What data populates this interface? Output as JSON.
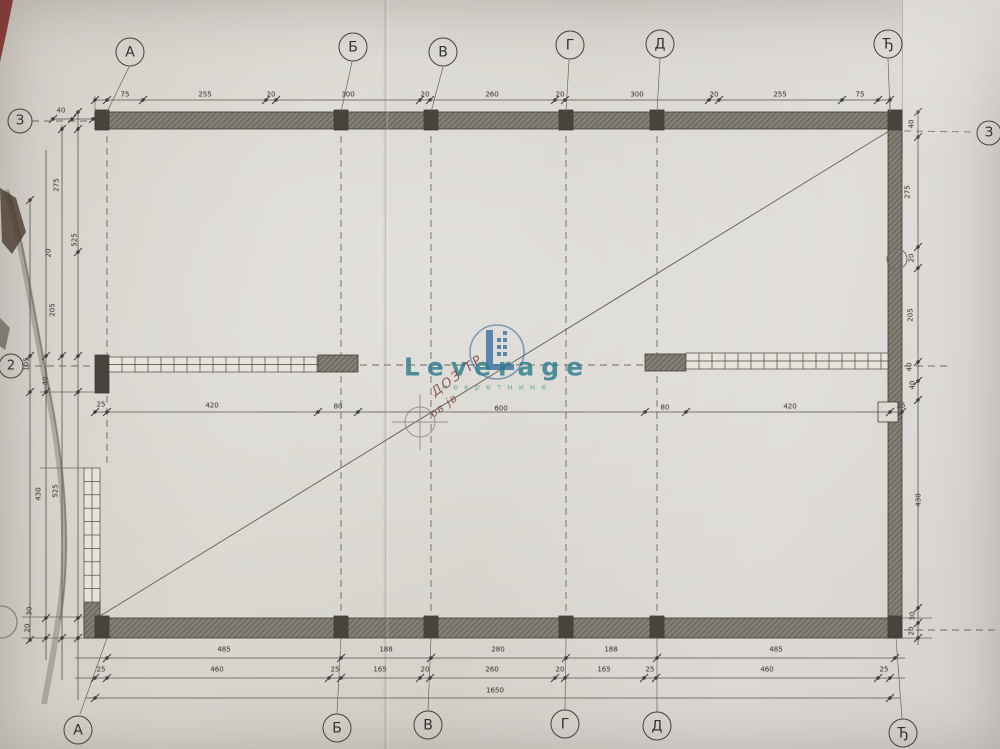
{
  "colors": {
    "paper": "#d8d5ce",
    "line": "#4a4741",
    "wall": "#847f75",
    "wall_dark": "#47443e",
    "accent_teal": "#2e7d8f",
    "accent_green": "#45a08c",
    "accent_blue": "#3b6ea5",
    "stamp_red": "#84453d"
  },
  "axes": {
    "top": [
      "А",
      "Б",
      "В",
      "Г",
      "Д",
      "Ђ"
    ],
    "bottom": [
      "А",
      "Б",
      "В",
      "Г",
      "Д",
      "Ђ"
    ],
    "left": [
      "З",
      "2"
    ],
    "right": [
      "З"
    ]
  },
  "dims": {
    "top": [
      "75",
      "255",
      "20",
      "300",
      "20",
      "260",
      "20",
      "300",
      "20",
      "255",
      "75"
    ],
    "top_small_left": [
      "40"
    ],
    "mid": [
      "25",
      "420",
      "80",
      "600",
      "80",
      "420",
      "25"
    ],
    "bottom_spans": [
      "485",
      "188",
      "280",
      "188",
      "485"
    ],
    "bottom_detail": [
      "25",
      "460",
      "25",
      "165",
      "20",
      "260",
      "20",
      "165",
      "25",
      "460",
      "25"
    ],
    "bottom_total": [
      "1650"
    ],
    "left": [
      "275",
      "20",
      "525",
      "205",
      "105",
      "40",
      "430",
      "525",
      "30",
      "20"
    ],
    "right": [
      "40",
      "275",
      "20",
      "205",
      "40",
      "40",
      "430",
      "30",
      "20"
    ]
  },
  "watermark": {
    "brand": "Leverage",
    "subtitle": "некретнине",
    "stamp_line1": "ДОЗ ТР",
    "stamp_line2": "ов јв"
  }
}
